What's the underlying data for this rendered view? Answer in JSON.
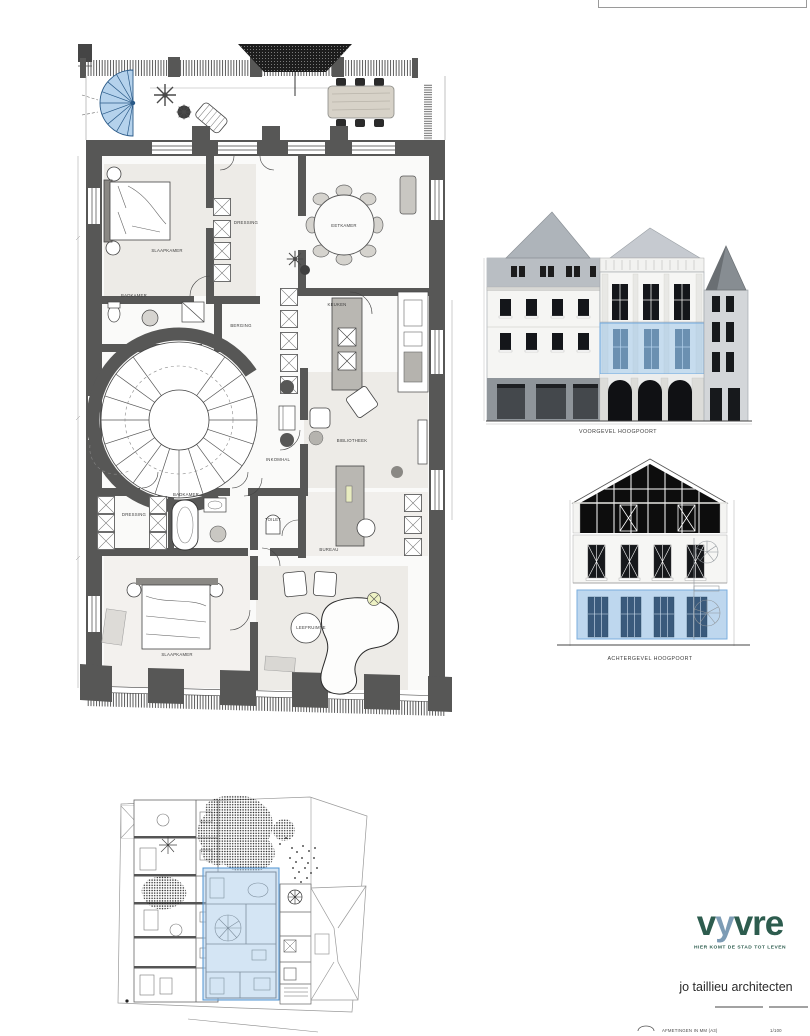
{
  "plan": {
    "rooms": [
      {
        "label": "SLAAPKAMER"
      },
      {
        "label": "DRESSING"
      },
      {
        "label": "EETKAMER"
      },
      {
        "label": "BADKAMER"
      },
      {
        "label": "BERGING"
      },
      {
        "label": "KEUKEN"
      },
      {
        "label": "INKOMHAL"
      },
      {
        "label": "BIBLIOTHEEK"
      },
      {
        "label": "DRESSING"
      },
      {
        "label": "BADKAMER"
      },
      {
        "label": "TOILET"
      },
      {
        "label": "BUREAU"
      },
      {
        "label": "SLAAPKAMER"
      },
      {
        "label": "LEEFRUIMTE"
      }
    ]
  },
  "elevations": [
    {
      "caption": "VOORGEVEL HOOGPOORT"
    },
    {
      "caption": "ACHTERGEVEL HOOGPOORT"
    }
  ],
  "branding": {
    "logo": {
      "part1": "v",
      "part2": "y",
      "part3": "vre"
    },
    "tagline": "HIER KOMT DE STAD TOT LEVEN",
    "architect": "jo taillieu architecten"
  },
  "footer": {
    "note": "AFMETINGEN IN MM (A3)",
    "scale": "1/100"
  },
  "colors": {
    "highlight": "#aecdea",
    "highlight_border": "#79aede",
    "wall": "#575756",
    "logo_green": "#2d5c4e",
    "logo_blue": "#7d9cb5"
  }
}
